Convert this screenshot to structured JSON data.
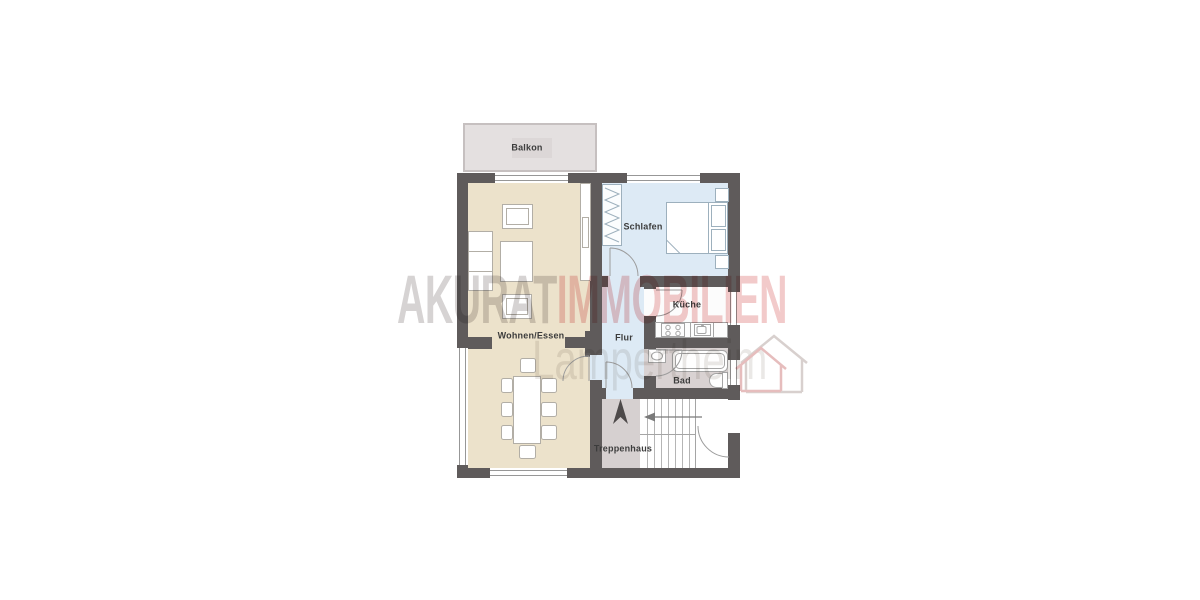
{
  "watermark": {
    "brand_primary": "AKURAT",
    "brand_secondary": "IMMOBILIEN",
    "brand_subtitle": "Lampertheim"
  },
  "rooms": {
    "balcony": {
      "label": "Balkon"
    },
    "living_dining": {
      "label": "Wohnen/Essen"
    },
    "bedroom": {
      "label": "Schlafen"
    },
    "kitchen": {
      "label": "Küche"
    },
    "hallway": {
      "label": "Flur"
    },
    "bathroom": {
      "label": "Bad"
    },
    "stairwell": {
      "label": "Treppenhaus"
    }
  },
  "colors": {
    "wall": "#5f5b5b",
    "living_floor": "#ece2cb",
    "bedroom_floor": "#ddeaf5",
    "hallway_floor": "#ddeaf5",
    "kitchen_floor": "#fcfcfc",
    "bathroom_floor": "#d9d2d2",
    "stairwell_floor": "#d6d0d0",
    "balcony_floor": "#e4e0e0",
    "watermark_gray": "#d6d3d3",
    "watermark_red": "#f2caca",
    "watermark_subtitle": "#eae8e6",
    "label_text": "#3c3c3c"
  }
}
